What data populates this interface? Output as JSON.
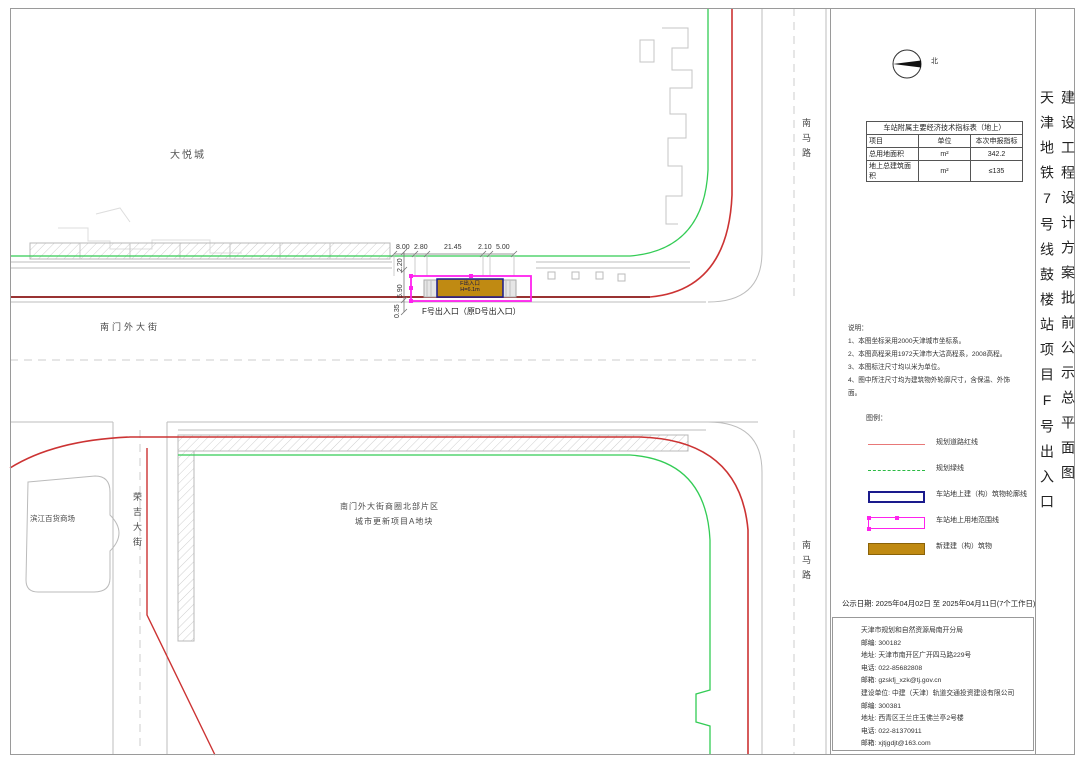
{
  "titles": {
    "project_vertical": "天津地铁7号线鼓楼站项目F号出入口",
    "drawing_vertical": "建设工程设计方案批前公示总平面图"
  },
  "compass": {
    "north_label": "北"
  },
  "indicator_table": {
    "title": "车站附属主要经济技术指标表（地上）",
    "headers": [
      "项目",
      "单位",
      "本次申报指标"
    ],
    "rows": [
      {
        "item": "总用地面积",
        "unit": "m²",
        "value": "342.2"
      },
      {
        "item": "地上总建筑面积",
        "unit": "m²",
        "value": "≤135"
      }
    ]
  },
  "notes": {
    "title": "说明：",
    "lines": [
      "1、本图坐标采用2000天津城市坐标系。",
      "2、本图高程采用1972天津市大沽高程系，2008高程。",
      "3、本图标注尺寸均以米为单位。",
      "4、图中所注尺寸均为建筑物外轮廓尺寸，含保温、外饰面。"
    ]
  },
  "legend": {
    "title": "图例：",
    "items": [
      {
        "label": "规划道路红线",
        "type": "red-line"
      },
      {
        "label": "规划绿线",
        "type": "green-dashed"
      },
      {
        "label": "车站地上建（构）筑物轮廓线",
        "type": "navy-rect"
      },
      {
        "label": "车站地上用地范围线",
        "type": "magenta-rect"
      },
      {
        "label": "新建建（构）筑物",
        "type": "gold-fill"
      }
    ]
  },
  "notice": {
    "date_line": "公示日期: 2025年04月02日 至 2025年04月11日(7个工作日)",
    "contact_lines": [
      "天津市规划和自然资源局南开分局",
      "邮编: 300182",
      "地址: 天津市南开区广开四马路229号",
      "电话: 022-85682808",
      "邮箱: gzskfj_xzk@tj.gov.cn",
      "建设单位: 中建（天津）轨道交通投资建设有限公司",
      "邮编: 300381",
      "地址: 西青区王兰庄玉佛兰亭2号楼",
      "电话: 022-81370911",
      "邮箱: xjtjgdjt@163.com"
    ]
  },
  "plan": {
    "labels": {
      "mall": "大悦城",
      "street_south": "南门外大街",
      "road_nanma_upper": "南马路",
      "road_nanma_lower": "南马路",
      "road_rongji": "荣吉大街",
      "binjiang_store": "滨江百货商场",
      "renewal_line1": "南门外大街商圈北部片区",
      "renewal_line2": "城市更新项目A地块",
      "exit_label": "F号出入口（原D号出入口）"
    },
    "dims_top": [
      "8.00",
      "2.80",
      "21.45",
      "2.10",
      "5.00"
    ],
    "dims_left": [
      "2.20",
      "5.90",
      "0.35"
    ],
    "station_box": {
      "line1": "F出入口",
      "line2": "H=6.1m"
    }
  },
  "colors": {
    "road_red_line": "#cc3333",
    "road_red_dark": "#993333",
    "green_line": "#33cc55",
    "station_outline_navy": "#1a1a8c",
    "site_boundary_magenta": "#ff22ee",
    "new_building_fill": "#c08a12",
    "building_gray": "#bbbbbb"
  }
}
